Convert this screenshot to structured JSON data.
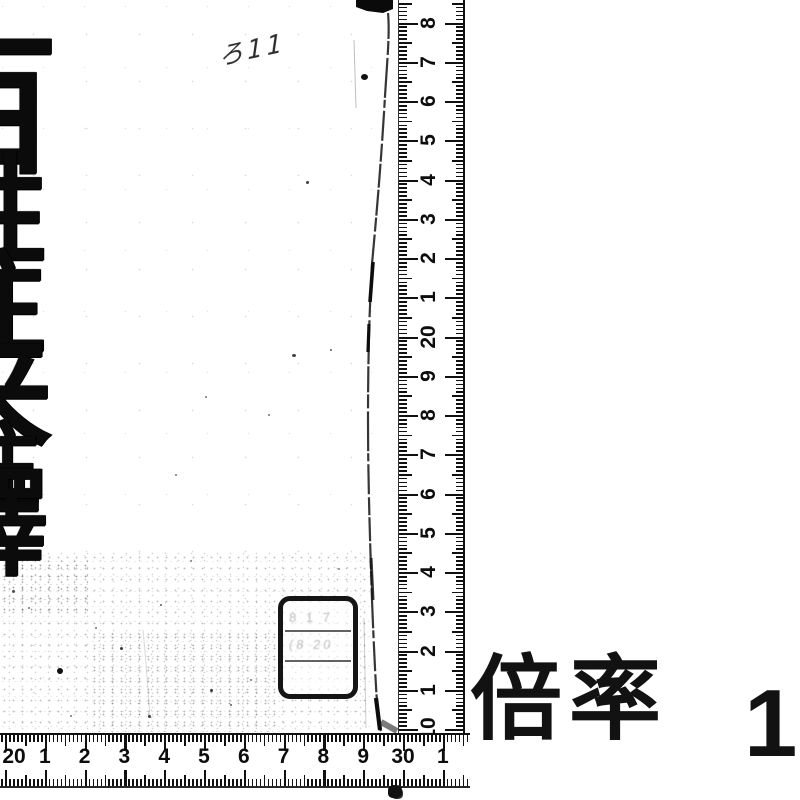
{
  "scan": {
    "shelf_mark": "ろ11",
    "title_characters": [
      "百",
      "姓",
      "往",
      "来",
      "注",
      "釋"
    ],
    "stamp": {
      "row1_faint_marks": "8 1 7",
      "row2_faint_marks": "(8 20",
      "row3_faint_marks": ""
    },
    "magnification": {
      "label": "倍率",
      "value": "1"
    },
    "rulers": {
      "vertical": {
        "unit": "cm",
        "labels_top_to_bottom": [
          "8",
          "7",
          "6",
          "5",
          "4",
          "3",
          "2",
          "1",
          "20",
          "9",
          "8",
          "7",
          "6",
          "5",
          "4",
          "3",
          "2",
          "1",
          "10"
        ]
      },
      "horizontal": {
        "unit": "cm",
        "labels_left_to_right": [
          "20",
          "1",
          "2",
          "3",
          "4",
          "5",
          "6",
          "7",
          "8",
          "9",
          "30",
          "1"
        ]
      }
    }
  }
}
